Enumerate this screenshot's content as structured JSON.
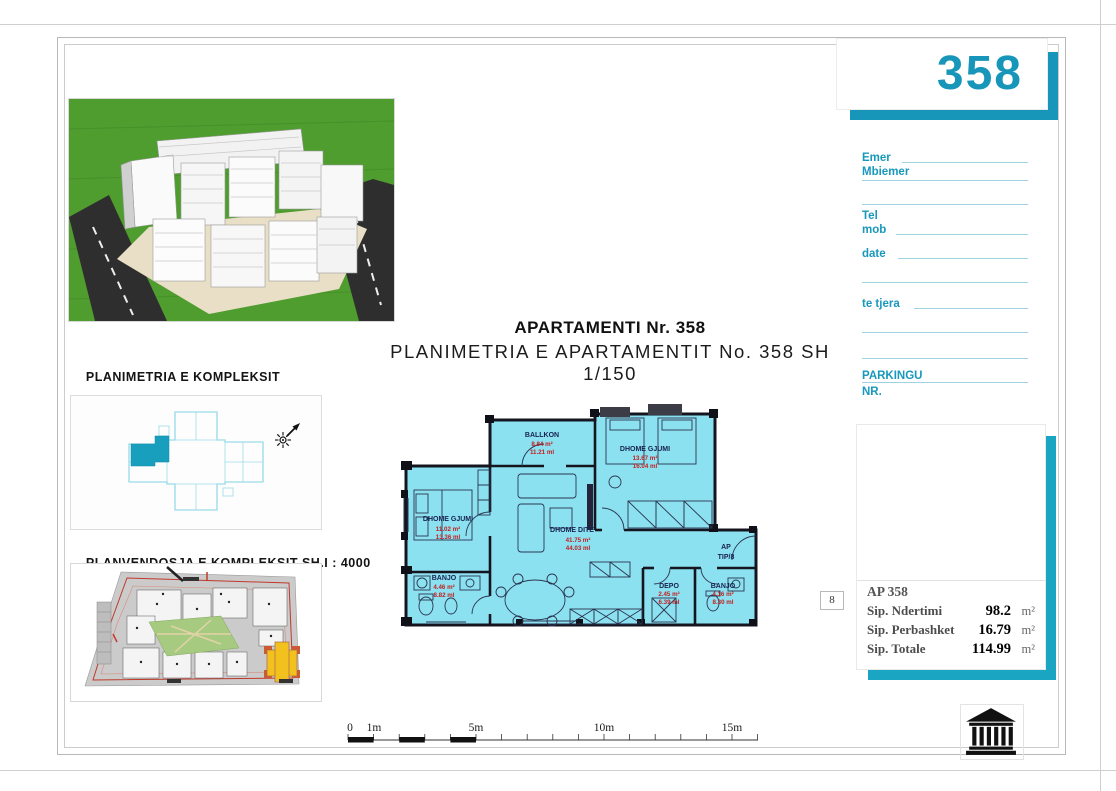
{
  "header": {
    "number": "358"
  },
  "titles": {
    "line1": "APARTAMENTI Nr. 358",
    "line2": "PLANIMETRIA E APARTAMENTIT No. 358 SH 1/150"
  },
  "left_panel": {
    "section_title_1": "PLANIMETRIA E KOMPLEKSIT",
    "section_title_2": "SEKSIONI 3  SH 1/750",
    "siteplan_title": "PLANVENDOSJA E KOMPLEKSIT SH.I : 4000"
  },
  "form": {
    "emer": "Emer",
    "mbiemer": "Mbiemer",
    "tel": "Tel",
    "mob": "mob",
    "date": "date",
    "te_tjera": "te tjera",
    "parkingu": "PARKINGU",
    "nr": "NR."
  },
  "summary": {
    "marker": "8",
    "title": "AP 358",
    "rows": [
      {
        "label": "Sip. Ndertimi",
        "value": "98.2",
        "unit": "m²"
      },
      {
        "label": "Sip. Perbashket",
        "value": "16.79",
        "unit": "m²"
      },
      {
        "label": "Sip. Totale",
        "value": "114.99",
        "unit": "m²"
      }
    ]
  },
  "floorplan": {
    "ap_tip_1": "AP",
    "ap_tip_2": "TIP/8",
    "rooms": {
      "ballkon": {
        "name": "BALLKON",
        "area": "8.84 m²",
        "perimeter": "11.21 ml"
      },
      "gjumi1": {
        "name": "DHOME GJUMI",
        "area": "11.02 m²",
        "perimeter": "13.36 ml"
      },
      "gjumi2": {
        "name": "DHOME GJUMI",
        "area": "13.67 m²",
        "perimeter": "16.04 ml"
      },
      "dite": {
        "name": "DHOME DITE",
        "area": "41.75 m²",
        "perimeter": "44.03 ml"
      },
      "banjo1": {
        "name": "BANJO",
        "area": "4.46 m²",
        "perimeter": "8.82 ml"
      },
      "depo": {
        "name": "DEPO",
        "area": "2.45 m²",
        "perimeter": "6.39 ml"
      },
      "banjo2": {
        "name": "BANJO",
        "area": "4.16 m²",
        "perimeter": "8.30 ml"
      }
    }
  },
  "scalebar": {
    "labels": [
      "0",
      "1m",
      "5m",
      "10m",
      "15m"
    ]
  },
  "colors": {
    "accent_teal": "#1796ba",
    "plan_fill": "#8ce1f0",
    "plan_highlight": "#189fbe",
    "value_red": "#c41e1e",
    "render_green": "#4f9c2f",
    "site_yellow": "#f3c11d"
  }
}
